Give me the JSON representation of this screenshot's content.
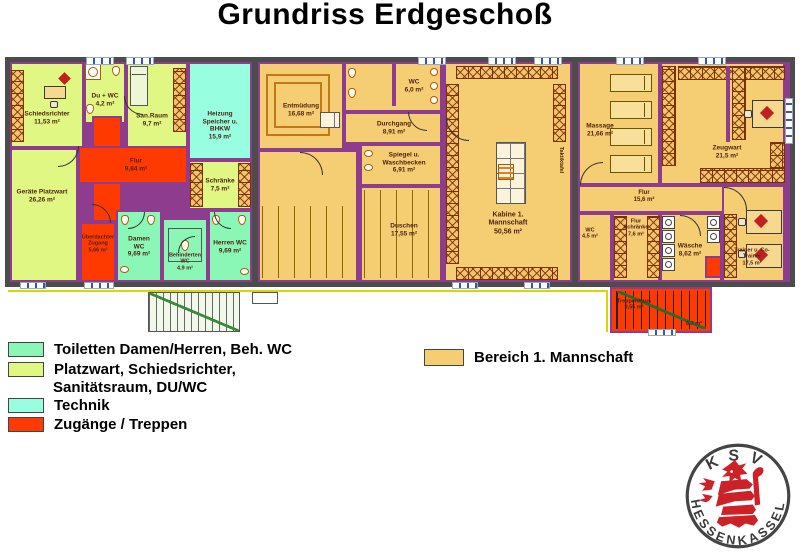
{
  "title": "Grundriss Erdgeschoß",
  "colors": {
    "wall": "#4c4c4c",
    "inner_wall": "#8e3d8e",
    "tm": "#f5cd72",
    "pw": "#e0f883",
    "to": "#8bf7b6",
    "tk": "#97fee0",
    "zg": "#ff3a00",
    "room_label": "#4f2313"
  },
  "legend_left": {
    "items": [
      {
        "color": "to",
        "label": "Toiletten Damen/Herren, Beh. WC"
      },
      {
        "color": "pw",
        "label": "Platzwart, Schiedsrichter,",
        "label2": "Sanitätsraum, DU/WC"
      },
      {
        "color": "tk",
        "label": "Technik"
      },
      {
        "color": "zg",
        "label": "Zugänge / Treppen"
      }
    ]
  },
  "legend_right": {
    "color": "tm",
    "label": "Bereich 1. Mannschaft"
  },
  "logo": {
    "top": "KSV",
    "bottom_left": "HESSEN",
    "bottom_right": "KASSEL"
  },
  "plan": {
    "rooms": [
      {
        "id": "schiedsrichter",
        "x": 10,
        "y": 62,
        "w": 74,
        "h": 86,
        "c": "pw",
        "label": "Schiedsrichter",
        "area": "11,53 m²",
        "lx": 47,
        "ly": 118,
        "lw": 54
      },
      {
        "id": "du-wc",
        "x": 84,
        "y": 62,
        "w": 42,
        "h": 62,
        "c": "pw",
        "label": "Du + WC",
        "area": "4,2 m²",
        "lx": 105,
        "ly": 100,
        "lw": 36
      },
      {
        "id": "san-raum",
        "x": 126,
        "y": 62,
        "w": 62,
        "h": 86,
        "c": "pw",
        "label": "San.Raum",
        "area": "9,7 m²",
        "lx": 152,
        "ly": 120,
        "lw": 40
      },
      {
        "id": "technik-heizung",
        "x": 188,
        "y": 62,
        "w": 64,
        "h": 98,
        "c": "tk",
        "label": "Heizung Speicher u. BHKW",
        "area": "15,9 m²",
        "lx": 220,
        "ly": 126,
        "lw": 52
      },
      {
        "id": "geraete-platzwart",
        "x": 10,
        "y": 148,
        "w": 68,
        "h": 134,
        "c": "pw",
        "label": "Geräte Platzwart",
        "area": "26,26 m²",
        "lx": 42,
        "ly": 196,
        "lw": 54
      },
      {
        "id": "flur-vertikal",
        "x": 92,
        "y": 116,
        "w": 30,
        "h": 106,
        "c": "zg"
      },
      {
        "id": "flur",
        "x": 78,
        "y": 146,
        "w": 110,
        "h": 38,
        "c": "zg",
        "label": "Flur",
        "area": "9,84 m²",
        "lx": 136,
        "ly": 165,
        "lw": 40
      },
      {
        "id": "ueberdachter-zugang",
        "x": 80,
        "y": 222,
        "w": 36,
        "h": 60,
        "c": "zg",
        "label": "Überdachter Zugang",
        "area": "5,66 m²",
        "lx": 98,
        "ly": 244,
        "lw": 34,
        "fs": 5.5
      },
      {
        "id": "schraenke",
        "x": 188,
        "y": 160,
        "w": 64,
        "h": 50,
        "c": "pw",
        "label": "Schränke",
        "area": "7,5 m²",
        "lx": 220,
        "ly": 185,
        "lw": 40
      },
      {
        "id": "damen-wc",
        "x": 116,
        "y": 210,
        "w": 46,
        "h": 72,
        "c": "to",
        "label": "Damen WC",
        "area": "9,69 m²",
        "lx": 139,
        "ly": 247,
        "lw": 34
      },
      {
        "id": "beh-wc",
        "x": 162,
        "y": 218,
        "w": 46,
        "h": 64,
        "c": "to",
        "label": "Behinderten WC",
        "area": "4,9 m²",
        "lx": 185,
        "ly": 262,
        "lw": 42,
        "fs": 5.5
      },
      {
        "id": "herren-wc",
        "x": 208,
        "y": 210,
        "w": 44,
        "h": 72,
        "c": "to",
        "label": "Herren WC",
        "area": "9,69 m²",
        "lx": 230,
        "ly": 247,
        "lw": 34
      },
      {
        "id": "entmuedung",
        "x": 258,
        "y": 62,
        "w": 86,
        "h": 88,
        "c": "tm",
        "label": "Entmüdung",
        "area": "16,68 m²",
        "lx": 301,
        "ly": 110,
        "lw": 44
      },
      {
        "id": "duschraum-links",
        "x": 258,
        "y": 150,
        "w": 100,
        "h": 132,
        "c": "tm"
      },
      {
        "id": "wc-mitte",
        "x": 344,
        "y": 62,
        "w": 98,
        "h": 50,
        "c": "tm",
        "label": "WC",
        "area": "6,0 m²",
        "lx": 414,
        "ly": 86,
        "lw": 30
      },
      {
        "id": "durchgang",
        "x": 344,
        "y": 112,
        "w": 98,
        "h": 32,
        "c": "tm",
        "label": "Durchgang",
        "area": "8,91 m²",
        "lx": 394,
        "ly": 128,
        "lw": 44
      },
      {
        "id": "spiegel-waschbecken",
        "x": 360,
        "y": 144,
        "w": 82,
        "h": 42,
        "c": "tm",
        "label": "Spiegel u. Waschbecken",
        "area": "6,91 m²",
        "lx": 404,
        "ly": 163,
        "lw": 50
      },
      {
        "id": "duschen",
        "x": 360,
        "y": 186,
        "w": 82,
        "h": 96,
        "c": "tm",
        "label": "Duschen",
        "area": "17,55 m²",
        "lx": 404,
        "ly": 230,
        "lw": 40
      },
      {
        "id": "kabine-1-mannschaft",
        "x": 444,
        "y": 62,
        "w": 128,
        "h": 220,
        "c": "tm",
        "label": "Kabine 1. Mannschaft",
        "area": "50,56 m²",
        "lx": 508,
        "ly": 224,
        "lw": 54,
        "fs": 7
      },
      {
        "id": "massage",
        "x": 578,
        "y": 62,
        "w": 82,
        "h": 123,
        "c": "tm",
        "label": "Massage",
        "area": "21,66 m²",
        "lx": 600,
        "ly": 130,
        "lw": 36
      },
      {
        "id": "zeugwart",
        "x": 660,
        "y": 62,
        "w": 125,
        "h": 123,
        "c": "tm",
        "label": "Zeugwart",
        "area": "21,5 m²",
        "lx": 727,
        "ly": 152,
        "lw": 40
      },
      {
        "id": "flur-rechts",
        "x": 578,
        "y": 185,
        "w": 146,
        "h": 28,
        "c": "tm",
        "label": "Flur",
        "area": "15,6 m²",
        "lx": 644,
        "ly": 197,
        "lw": 40,
        "fs": 6
      },
      {
        "id": "wc-rechts",
        "x": 578,
        "y": 213,
        "w": 34,
        "h": 69,
        "c": "tm",
        "label": "WC",
        "area": "4,5 m²",
        "lx": 590,
        "ly": 234,
        "lw": 26,
        "fs": 5.5
      },
      {
        "id": "flur-schraenke",
        "x": 612,
        "y": 213,
        "w": 48,
        "h": 69,
        "c": "tm",
        "label": "Flur Schränke",
        "area": "7,6 m²",
        "lx": 636,
        "ly": 228,
        "lw": 30,
        "fs": 5.5
      },
      {
        "id": "waesche",
        "x": 660,
        "y": 213,
        "w": 62,
        "h": 69,
        "c": "tm",
        "label": "Wäsche",
        "area": "8,62 m²",
        "lx": 690,
        "ly": 250,
        "lw": 34
      },
      {
        "id": "trainer-co-trainer",
        "x": 722,
        "y": 185,
        "w": 63,
        "h": 97,
        "c": "tm",
        "label": "Trainer u. Co-Trainer",
        "area": "17,5 m²",
        "lx": 752,
        "ly": 257,
        "lw": 40,
        "fs": 5.5
      },
      {
        "id": "treppenhaus",
        "x": 610,
        "y": 287,
        "w": 102,
        "h": 46,
        "c": "zg",
        "label": "Treppenhaus",
        "area": "9,55 m²",
        "lx": 634,
        "ly": 305,
        "lw": 40,
        "fs": 5.5
      }
    ],
    "texts": [
      {
        "text": "Taktiktafel",
        "x": 561,
        "y": 160,
        "vertical": true
      },
      {
        "text": "6,7 m²",
        "x": 694,
        "y": 324
      }
    ],
    "fixtures": [
      {
        "t": "walld",
        "x": 252,
        "y": 62,
        "w": 6,
        "h": 220
      },
      {
        "t": "walld",
        "x": 572,
        "y": 62,
        "w": 6,
        "h": 220
      },
      {
        "t": "bench",
        "x": 11,
        "y": 70,
        "w": 13,
        "h": 72
      },
      {
        "t": "desk",
        "x": 44,
        "y": 86,
        "w": 22,
        "h": 13
      },
      {
        "t": "chair",
        "x": 50,
        "y": 101,
        "w": 8,
        "h": 7
      },
      {
        "t": "diamond",
        "x": 60,
        "y": 74,
        "w": 9,
        "h": 9
      },
      {
        "t": "shower",
        "x": 85,
        "y": 64,
        "w": 16,
        "h": 16
      },
      {
        "t": "wc",
        "x": 112,
        "y": 66,
        "w": 8,
        "h": 10
      },
      {
        "t": "wc",
        "x": 86,
        "y": 104,
        "w": 8,
        "h": 10
      },
      {
        "t": "bed",
        "x": 130,
        "y": 66,
        "w": 18,
        "h": 40
      },
      {
        "t": "bench",
        "x": 173,
        "y": 68,
        "w": 13,
        "h": 64
      },
      {
        "t": "bench",
        "x": 190,
        "y": 163,
        "w": 13,
        "h": 44
      },
      {
        "t": "bench",
        "x": 238,
        "y": 163,
        "w": 13,
        "h": 44
      },
      {
        "t": "wc",
        "x": 121,
        "y": 215,
        "w": 8,
        "h": 10
      },
      {
        "t": "wc",
        "x": 147,
        "y": 215,
        "w": 8,
        "h": 10
      },
      {
        "t": "sink",
        "x": 120,
        "y": 266,
        "w": 9,
        "h": 7
      },
      {
        "t": "sq",
        "x": 168,
        "y": 228,
        "w": 34,
        "h": 34
      },
      {
        "t": "wc",
        "x": 181,
        "y": 240,
        "w": 8,
        "h": 11
      },
      {
        "t": "wc",
        "x": 212,
        "y": 215,
        "w": 8,
        "h": 10
      },
      {
        "t": "wc",
        "x": 238,
        "y": 215,
        "w": 8,
        "h": 10
      },
      {
        "t": "sink",
        "x": 240,
        "y": 268,
        "w": 9,
        "h": 7
      },
      {
        "t": "pool",
        "x": 266,
        "y": 74,
        "w": 64,
        "h": 62
      },
      {
        "t": "grid",
        "x": 320,
        "y": 112,
        "w": 20,
        "h": 16
      },
      {
        "t": "stalls",
        "x": 262,
        "y": 206,
        "w": 92,
        "h": 72
      },
      {
        "t": "wc",
        "x": 348,
        "y": 68,
        "w": 8,
        "h": 10
      },
      {
        "t": "wc",
        "x": 348,
        "y": 88,
        "w": 8,
        "h": 10
      },
      {
        "t": "sink",
        "x": 430,
        "y": 68,
        "w": 8,
        "h": 8
      },
      {
        "t": "sink",
        "x": 430,
        "y": 82,
        "w": 8,
        "h": 8
      },
      {
        "t": "sink",
        "x": 430,
        "y": 96,
        "w": 8,
        "h": 8
      },
      {
        "t": "wallp",
        "x": 392,
        "y": 62,
        "w": 4,
        "h": 44
      },
      {
        "t": "sink",
        "x": 364,
        "y": 150,
        "w": 9,
        "h": 7
      },
      {
        "t": "sink",
        "x": 364,
        "y": 164,
        "w": 9,
        "h": 7
      },
      {
        "t": "stalls",
        "x": 364,
        "y": 190,
        "w": 74,
        "h": 88
      },
      {
        "t": "bench",
        "x": 456,
        "y": 66,
        "w": 102,
        "h": 13
      },
      {
        "t": "bench",
        "x": 446,
        "y": 84,
        "w": 13,
        "h": 180
      },
      {
        "t": "bench",
        "x": 553,
        "y": 84,
        "w": 13,
        "h": 58
      },
      {
        "t": "bench",
        "x": 456,
        "y": 267,
        "w": 102,
        "h": 13
      },
      {
        "t": "grid",
        "x": 496,
        "y": 142,
        "w": 30,
        "h": 62
      },
      {
        "t": "hatch",
        "x": 498,
        "y": 164,
        "w": 16,
        "h": 16
      },
      {
        "t": "table",
        "x": 610,
        "y": 74,
        "w": 42,
        "h": 18
      },
      {
        "t": "table",
        "x": 610,
        "y": 101,
        "w": 42,
        "h": 18
      },
      {
        "t": "table",
        "x": 610,
        "y": 128,
        "w": 42,
        "h": 18
      },
      {
        "t": "table",
        "x": 610,
        "y": 155,
        "w": 42,
        "h": 18
      },
      {
        "t": "bench",
        "x": 662,
        "y": 66,
        "w": 14,
        "h": 100
      },
      {
        "t": "bench",
        "x": 678,
        "y": 66,
        "w": 107,
        "h": 14
      },
      {
        "t": "wallp",
        "x": 726,
        "y": 66,
        "w": 4,
        "h": 76
      },
      {
        "t": "bench",
        "x": 732,
        "y": 66,
        "w": 14,
        "h": 74
      },
      {
        "t": "bench",
        "x": 700,
        "y": 168,
        "w": 85,
        "h": 15
      },
      {
        "t": "bench",
        "x": 770,
        "y": 142,
        "w": 15,
        "h": 26
      },
      {
        "t": "desk",
        "x": 752,
        "y": 100,
        "w": 32,
        "h": 28
      },
      {
        "t": "diamond",
        "x": 762,
        "y": 108,
        "w": 10,
        "h": 10
      },
      {
        "t": "chair",
        "x": 744,
        "y": 110,
        "w": 8,
        "h": 8
      },
      {
        "t": "bench",
        "x": 614,
        "y": 216,
        "w": 13,
        "h": 62
      },
      {
        "t": "bench",
        "x": 647,
        "y": 216,
        "w": 13,
        "h": 62
      },
      {
        "t": "washer",
        "x": 662,
        "y": 216,
        "w": 13,
        "h": 13
      },
      {
        "t": "washer",
        "x": 662,
        "y": 230,
        "w": 13,
        "h": 13
      },
      {
        "t": "washer",
        "x": 662,
        "y": 244,
        "w": 13,
        "h": 13
      },
      {
        "t": "washer",
        "x": 662,
        "y": 258,
        "w": 13,
        "h": 13
      },
      {
        "t": "washer",
        "x": 707,
        "y": 216,
        "w": 13,
        "h": 13
      },
      {
        "t": "washer",
        "x": 707,
        "y": 230,
        "w": 13,
        "h": 13
      },
      {
        "t": "redbox",
        "x": 705,
        "y": 256,
        "w": 17,
        "h": 22
      },
      {
        "t": "bench",
        "x": 724,
        "y": 214,
        "w": 13,
        "h": 64
      },
      {
        "t": "desk",
        "x": 746,
        "y": 210,
        "w": 36,
        "h": 24
      },
      {
        "t": "diamond",
        "x": 756,
        "y": 216,
        "w": 10,
        "h": 10
      },
      {
        "t": "desk",
        "x": 746,
        "y": 244,
        "w": 36,
        "h": 24
      },
      {
        "t": "diamond",
        "x": 756,
        "y": 250,
        "w": 10,
        "h": 10
      },
      {
        "t": "chair",
        "x": 738,
        "y": 218,
        "w": 8,
        "h": 8
      },
      {
        "t": "chair",
        "x": 738,
        "y": 250,
        "w": 8,
        "h": 8
      },
      {
        "t": "stairred",
        "x": 616,
        "y": 291,
        "w": 90,
        "h": 38
      },
      {
        "t": "extstair",
        "x": 148,
        "y": 292,
        "w": 92,
        "h": 40
      },
      {
        "t": "stoop",
        "x": 252,
        "y": 292,
        "w": 26,
        "h": 12
      },
      {
        "t": "hline",
        "x": 8,
        "y": 290,
        "w": 600,
        "h": 2
      },
      {
        "t": "hline",
        "x": 606,
        "y": 292,
        "w": 2,
        "h": 40
      }
    ],
    "doors": [
      {
        "x": 58,
        "y": 146,
        "s": 20,
        "c": "br"
      },
      {
        "x": 124,
        "y": 96,
        "s": 18,
        "c": "bl"
      },
      {
        "x": 128,
        "y": 212,
        "s": 16,
        "c": "br"
      },
      {
        "x": 214,
        "y": 212,
        "s": 16,
        "c": "bl"
      },
      {
        "x": 178,
        "y": 236,
        "s": 16,
        "c": "tl"
      },
      {
        "x": 300,
        "y": 152,
        "s": 22,
        "c": "tr"
      },
      {
        "x": 408,
        "y": 112,
        "s": 18,
        "c": "bl"
      },
      {
        "x": 446,
        "y": 118,
        "s": 22,
        "c": "bl"
      },
      {
        "x": 580,
        "y": 162,
        "s": 22,
        "c": "tl"
      },
      {
        "x": 724,
        "y": 187,
        "s": 22,
        "c": "tr"
      },
      {
        "x": 680,
        "y": 215,
        "s": 20,
        "c": "tr"
      },
      {
        "x": 92,
        "y": 204,
        "s": 18,
        "c": "tr"
      }
    ],
    "windows": [
      {
        "x": 86,
        "y": 57,
        "w": 26,
        "h": 6
      },
      {
        "x": 126,
        "y": 57,
        "w": 26,
        "h": 6
      },
      {
        "x": 418,
        "y": 57,
        "w": 26,
        "h": 6
      },
      {
        "x": 488,
        "y": 57,
        "w": 26,
        "h": 6
      },
      {
        "x": 534,
        "y": 57,
        "w": 26,
        "h": 6
      },
      {
        "x": 616,
        "y": 57,
        "w": 26,
        "h": 6
      },
      {
        "x": 698,
        "y": 57,
        "w": 26,
        "h": 6
      },
      {
        "x": 20,
        "y": 282,
        "w": 24,
        "h": 5
      },
      {
        "x": 452,
        "y": 282,
        "w": 24,
        "h": 5
      },
      {
        "x": 524,
        "y": 282,
        "w": 24,
        "h": 5
      },
      {
        "x": 84,
        "y": 282,
        "w": 28,
        "h": 5
      },
      {
        "x": 648,
        "y": 329,
        "w": 26,
        "h": 5
      },
      {
        "x": 785,
        "y": 98,
        "w": 6,
        "h": 44,
        "v": true
      }
    ]
  }
}
